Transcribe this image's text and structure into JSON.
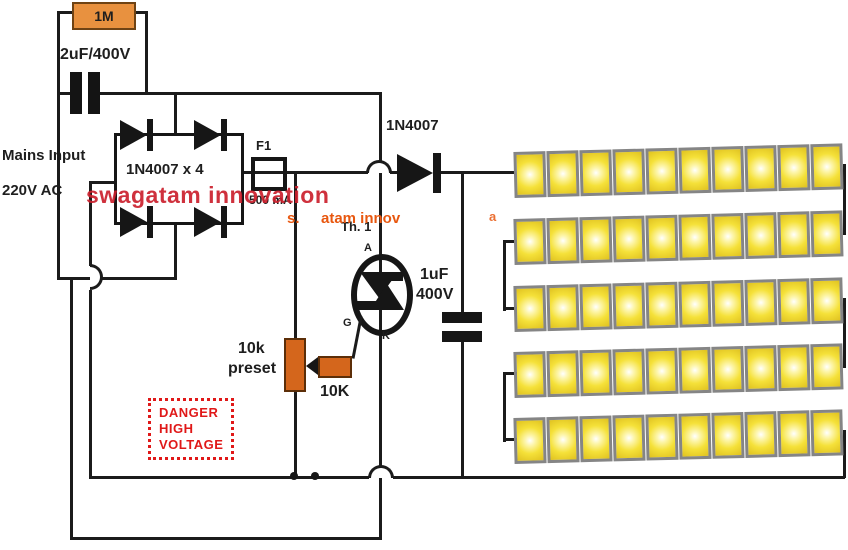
{
  "labels": {
    "mains_input": "Mains Input",
    "mains_voltage": "220V AC",
    "bleeder_resistor": "1M",
    "input_capacitor": "2uF/400V",
    "bridge": "1N4007 x 4",
    "fuse_name": "F1",
    "fuse_rating": "500 mA",
    "series_diode": "1N4007",
    "thyristor": "Th. 1",
    "anode": "A",
    "gate": "G",
    "cathode": "K",
    "filter_cap_value": "1uF",
    "filter_cap_voltage": "400V",
    "preset_value": "10k",
    "preset_word": "preset",
    "gate_resistor": "10K"
  },
  "warning": {
    "line1": "DANGER",
    "line2": "HIGH",
    "line3": "VOLTAGE"
  },
  "watermarks": {
    "main": "swagatam innovation",
    "frag1": "s.",
    "frag2": "atam innov",
    "frag3": "a"
  },
  "led_array": {
    "rows": 5,
    "leds_per_row": 10
  },
  "colors": {
    "wire": "#1B1B1B",
    "component_orange": "#E8913F",
    "deep_orange": "#D4661C",
    "led_yellow": "#F5E139",
    "led_border": "#858585",
    "warning_red": "#E01818",
    "watermark_red": "#CB202C",
    "watermark_orange": "#E8570F"
  }
}
